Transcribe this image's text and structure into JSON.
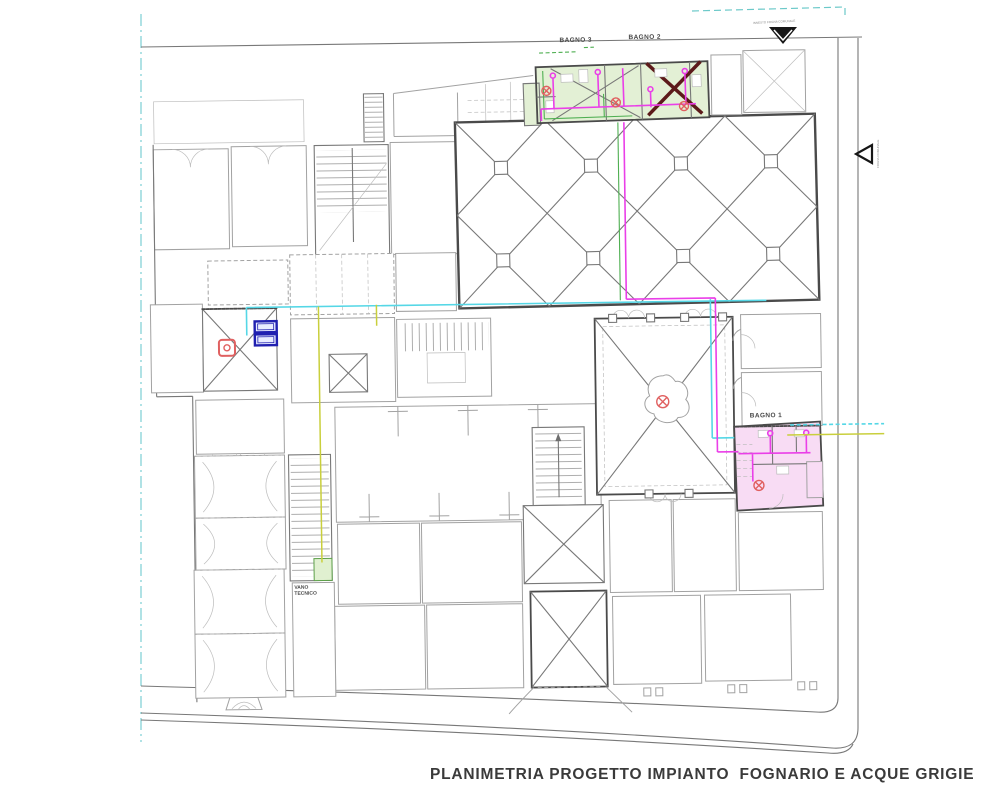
{
  "drawing": {
    "title": "PLANIMETRIA PROGETTO IMPIANTO  FOGNARIO E ACQUE GRIGIE",
    "room_labels": {
      "bagno_3": "BAGNO 3",
      "bagno_2": "BAGNO 2",
      "bagno_1": "BAGNO 1",
      "vano_tecnico_line_1": "VANO",
      "vano_tecnico_line_2": "TECNICO"
    },
    "annotations": {
      "top_outfall_note": "INNESTO FOGNA COMUNALE",
      "right_outfall_note": "FOGNA COMUNALE"
    },
    "symbols": {
      "top_outfall_arrow": "down-arrow",
      "right_outfall_arrow": "left-arrow",
      "floor_drain": "crossed-circle",
      "inspection_chamber": "blue-double-box",
      "roof_drain_marker": "red-rounded-square"
    },
    "colors": {
      "sewage_pipe_magenta": "#ea3fe8",
      "grey_water_pipe_cyan": "#55d7e6",
      "vent_pipe_yellow_green": "#c9cf3c",
      "ground_line_green": "#4faf52",
      "bathroom_highlight_green": "#e3f0d5",
      "bathroom_highlight_pink": "#f8dcf4",
      "drain_symbol_red": "#e06060",
      "chamber_blue": "#2020b0",
      "site_boundary_cyan": "#8fd6da",
      "dark_vault_cross": "#5c1a1a"
    }
  }
}
